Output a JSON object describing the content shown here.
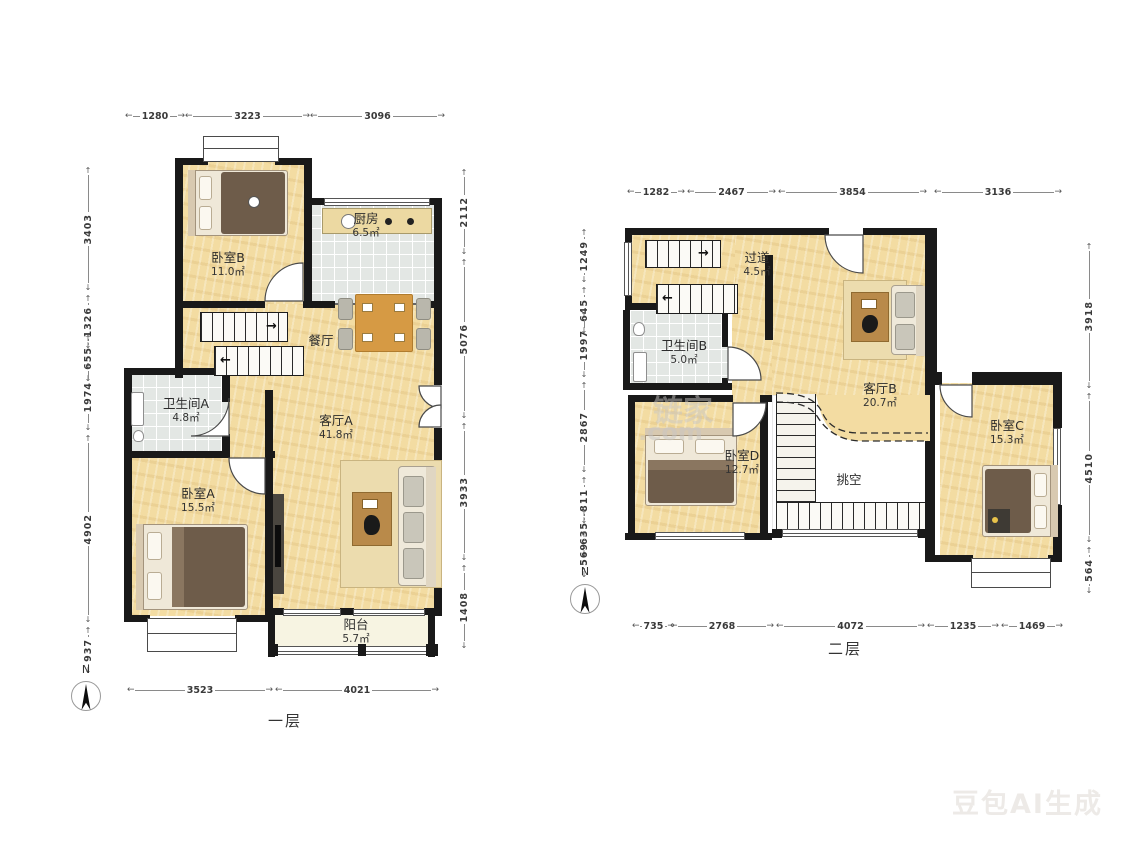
{
  "floor1": {
    "label": "一层",
    "north": "N",
    "rooms": {
      "bedroom_b": {
        "name": "卧室B",
        "area": "11.0㎡"
      },
      "kitchen": {
        "name": "厨房",
        "area": "6.5㎡"
      },
      "dining": {
        "name": "餐厅"
      },
      "bathroom_a": {
        "name": "卫生间A",
        "area": "4.8㎡"
      },
      "living_a": {
        "name": "客厅A",
        "area": "41.8㎡"
      },
      "bedroom_a": {
        "name": "卧室A",
        "area": "15.5㎡"
      },
      "balcony": {
        "name": "阳台",
        "area": "5.7㎡"
      }
    },
    "dims": {
      "top": [
        "1280",
        "3223",
        "3096"
      ],
      "left": [
        "3403",
        "1326",
        "655",
        "1974",
        "4902",
        "937"
      ],
      "right": [
        "2112",
        "5076",
        "3933",
        "1408"
      ],
      "bottom": [
        "3523",
        "4021"
      ]
    }
  },
  "floor2": {
    "label": "二层",
    "north": "N",
    "rooms": {
      "hallway": {
        "name": "过道",
        "area": "4.5㎡"
      },
      "bathroom_b": {
        "name": "卫生间B",
        "area": "5.0㎡"
      },
      "living_b": {
        "name": "客厅B",
        "area": "20.7㎡"
      },
      "bedroom_c": {
        "name": "卧室C",
        "area": "15.3㎡"
      },
      "bedroom_d": {
        "name": "卧室D",
        "area": "12.7㎡"
      },
      "void": {
        "name": "挑空"
      }
    },
    "dims": {
      "top": [
        "1282",
        "2467",
        "3854",
        "3136"
      ],
      "left": [
        "1249",
        "645",
        "1997",
        "2867",
        "811",
        "635",
        "569"
      ],
      "right": [
        "3918",
        "4510",
        "564"
      ],
      "bottom": [
        "735",
        "2768",
        "4072",
        "1235",
        "1469"
      ]
    }
  },
  "watermarks": {
    "brand": "链家",
    "brand_suffix": ".com",
    "generator": "豆包AI生成"
  }
}
